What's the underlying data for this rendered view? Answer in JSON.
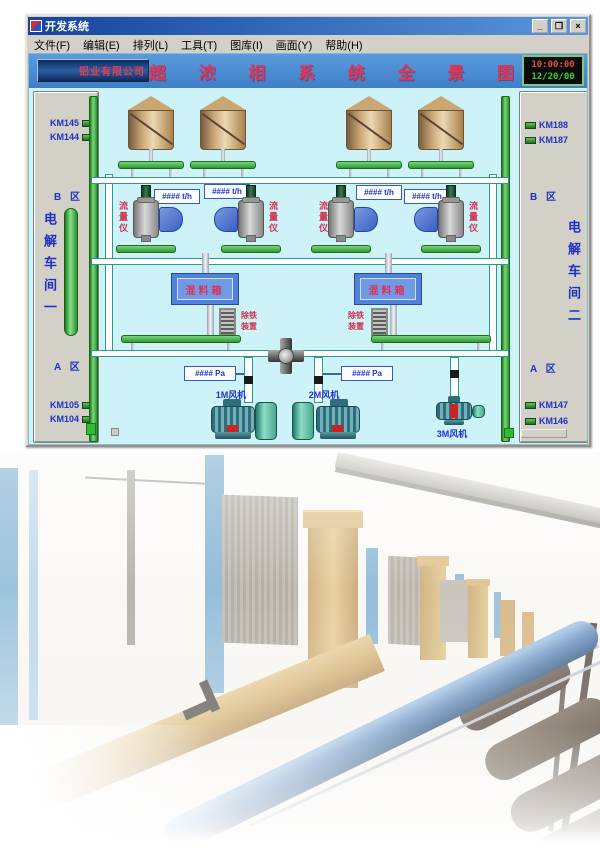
{
  "window": {
    "title": "开发系统",
    "menu": [
      "文件(F)",
      "编辑(E)",
      "排列(L)",
      "工具(T)",
      "图库(I)",
      "画面(Y)",
      "帮助(H)"
    ],
    "controls": {
      "minimize": "_",
      "maximize": "❐",
      "close": "×"
    }
  },
  "hmi": {
    "header": {
      "company": "铝业有限公司",
      "title": "超 浓 相 系 统 全 景 图",
      "clock_time": "10:00:00",
      "clock_date": "12/20/00"
    },
    "left_panel": {
      "tags_top": [
        "KM145",
        "KM144"
      ],
      "zone_b": "B 区",
      "workshop": "电解车间一",
      "zone_a": "A 区",
      "tags_bottom": [
        "KM105",
        "KM104"
      ]
    },
    "right_panel": {
      "tags_top": [
        "KM188",
        "KM187"
      ],
      "zone_b": "B 区",
      "workshop": "电解车间二",
      "zone_a": "A 区",
      "tags_bottom": [
        "KM147",
        "KM146"
      ]
    },
    "flow_displays": [
      "#### t/h",
      "#### t/h",
      "#### t/h",
      "#### t/h"
    ],
    "pressure_displays": [
      "#### Pa",
      "#### Pa"
    ],
    "labels": {
      "flow_meter": "流量仪",
      "mix_box": "混料箱",
      "iron_remover": "除铁装置",
      "fans": [
        "1M风机",
        "2M风机",
        "3M风机"
      ]
    }
  },
  "colors": {
    "canvas": "#cdf2f8",
    "pipe_green": "#3cb43c",
    "title_red": "#e43456",
    "display_blue": "#2233cc",
    "clock_time": "#e0503a",
    "clock_date": "#35d035",
    "panel_gray": "#d3d0c8"
  }
}
